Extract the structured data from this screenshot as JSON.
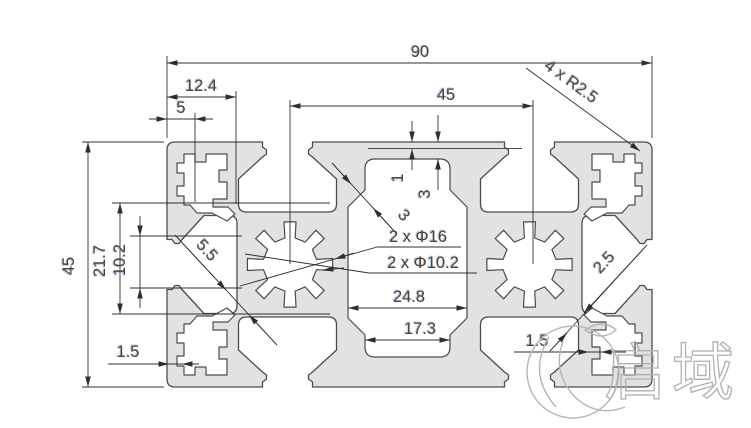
{
  "drawing": {
    "type": "aluminum-extrusion-profile-cross-section",
    "dims": {
      "overall_width": "90",
      "top_offset": "12.4",
      "screw_slot": "5",
      "bore_spacing": "45",
      "corner_radius": "4 x R2.5",
      "overall_height": "45",
      "side_cavity_height": "21.7",
      "side_slot_height": "10.2",
      "face_recess_depth": "1",
      "top_wall": "3",
      "center_web": "3",
      "left_web": "5.5",
      "bore_outer": "2 x Φ16",
      "bore_inner": "2 x Φ10.2",
      "cavity_width": "24.8",
      "cavity_opening": "17.3",
      "wall_bottom_left": "1.5",
      "wall_bottom_right": "1.5",
      "right_web": "2.5"
    },
    "watermark": {
      "brand_text": "启域"
    }
  }
}
